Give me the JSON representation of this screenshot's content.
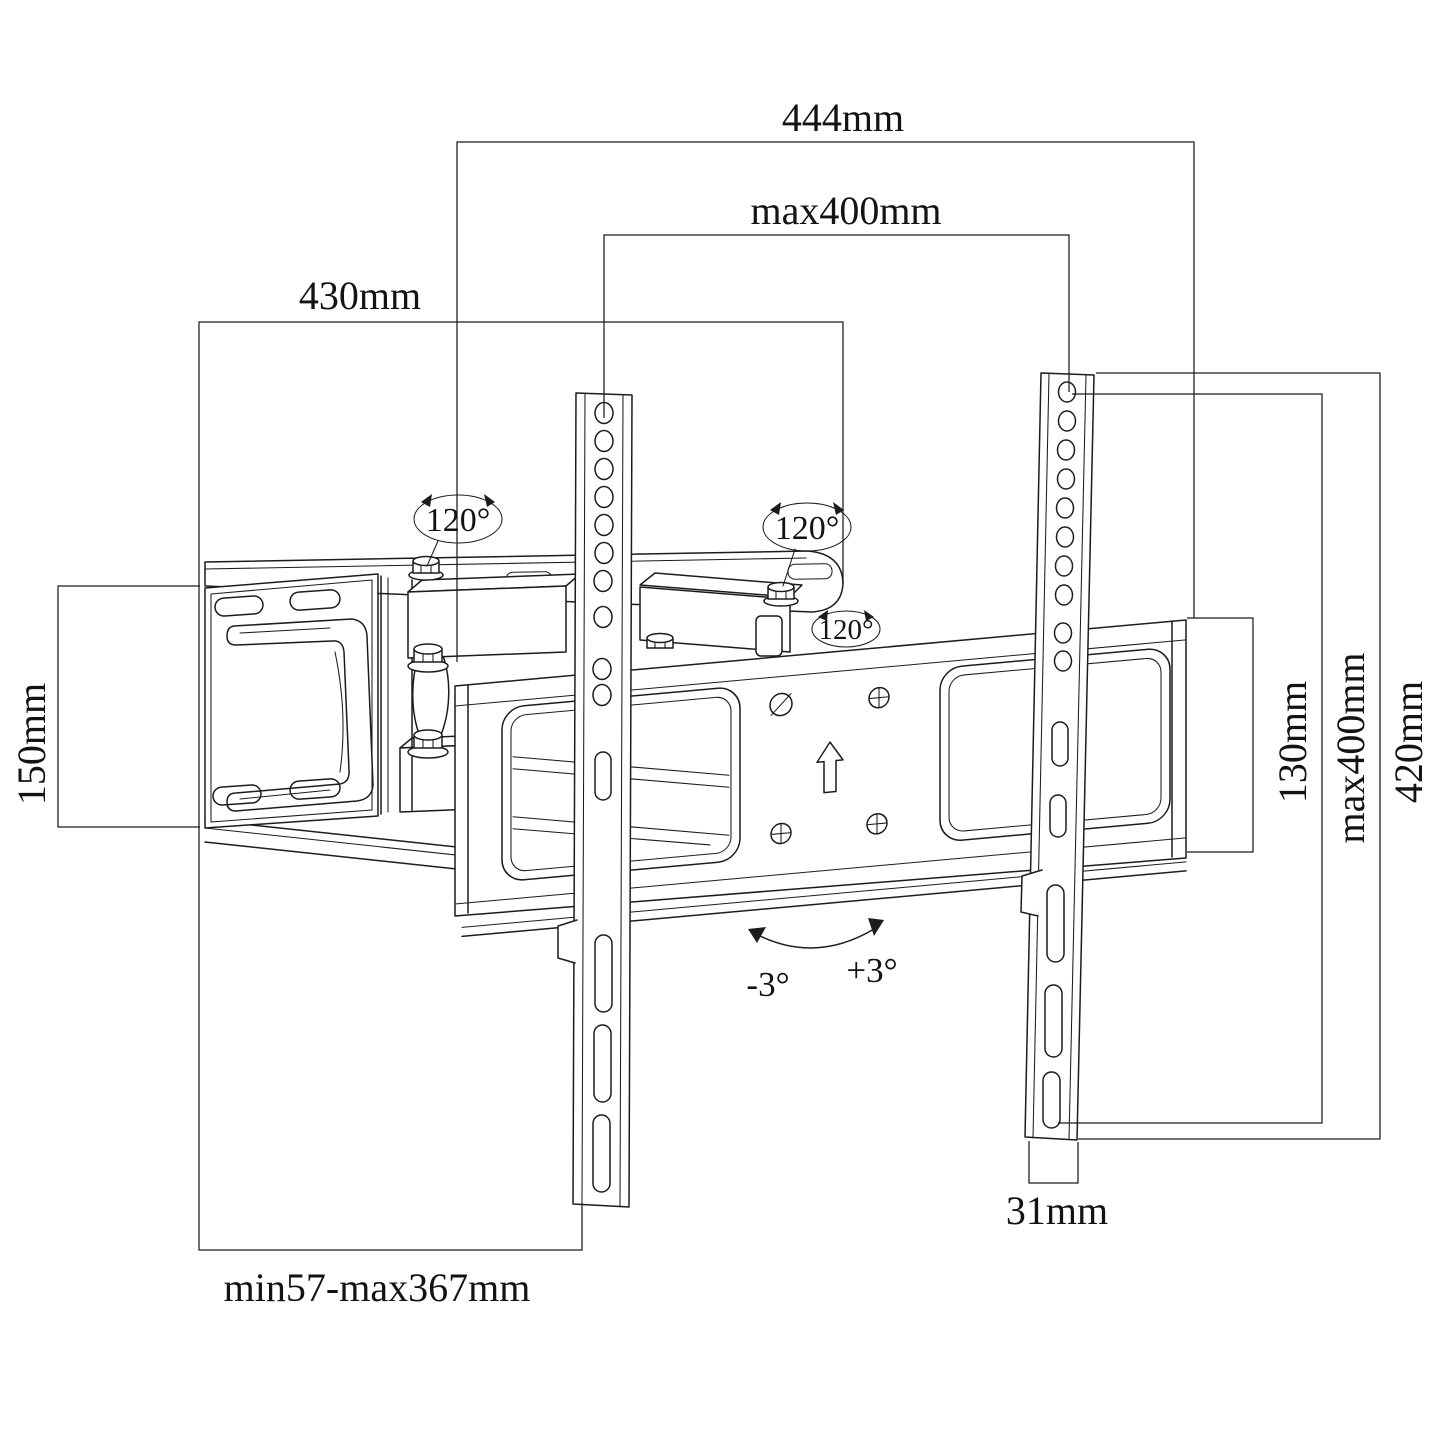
{
  "labels": {
    "dim444": "444mm",
    "dimMax400Top": "max400mm",
    "dim430": "430mm",
    "dim150": "150mm",
    "dimMinMax": "min57-max367mm",
    "dim31": "31mm",
    "dim130": "130mm",
    "dimMax400Right": "max400mm",
    "dim420": "420mm",
    "swivel1": "120°",
    "swivel2": "120°",
    "swivel3": "120°",
    "tiltNeg": "-3°",
    "tiltPos": "+3°"
  },
  "colors": {
    "line": "#1c1c1c",
    "background": "#ffffff"
  }
}
